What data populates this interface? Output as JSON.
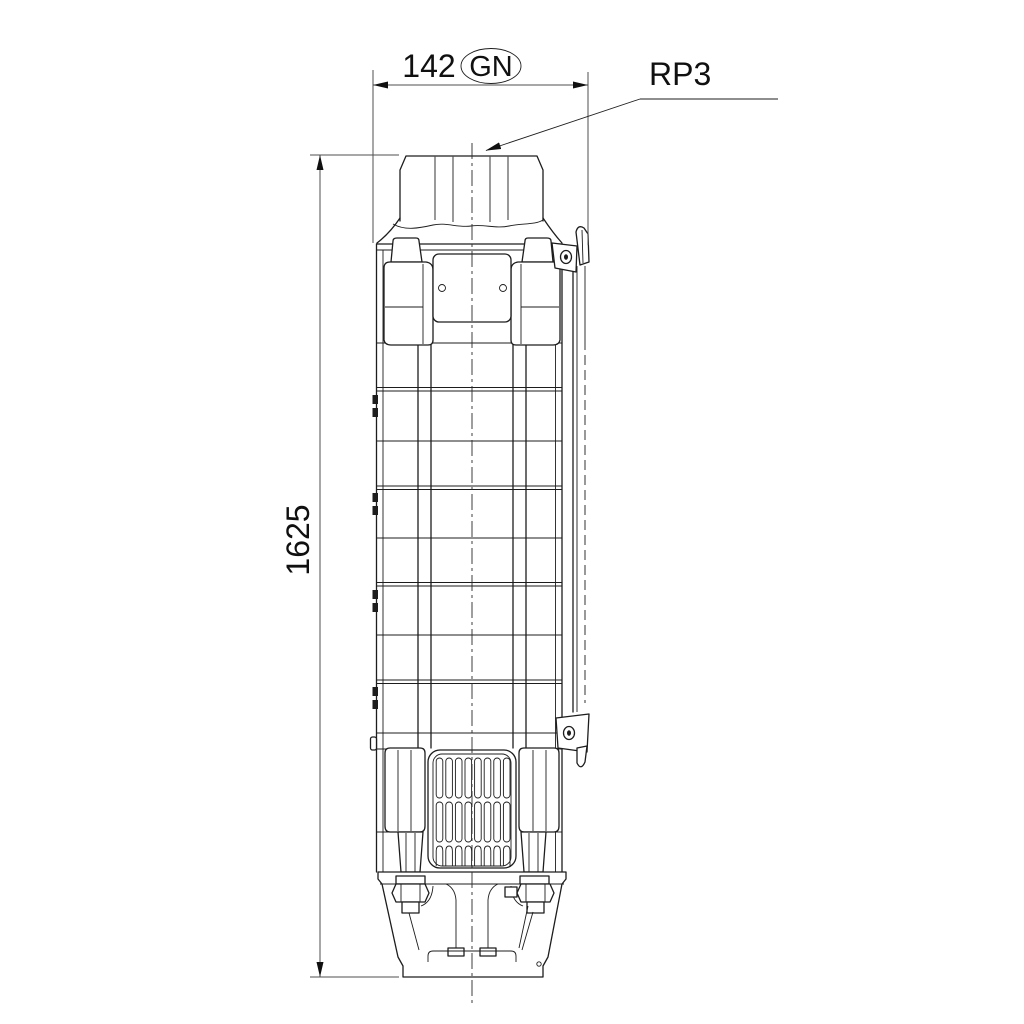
{
  "labels": {
    "width_value": "142",
    "width_tag": "GN",
    "height_value": "1625",
    "connection_label": "RP3"
  },
  "colors": {
    "line": "#1d1d1d",
    "dimension_line": "#4f4f4f",
    "background": "#ffffff"
  }
}
